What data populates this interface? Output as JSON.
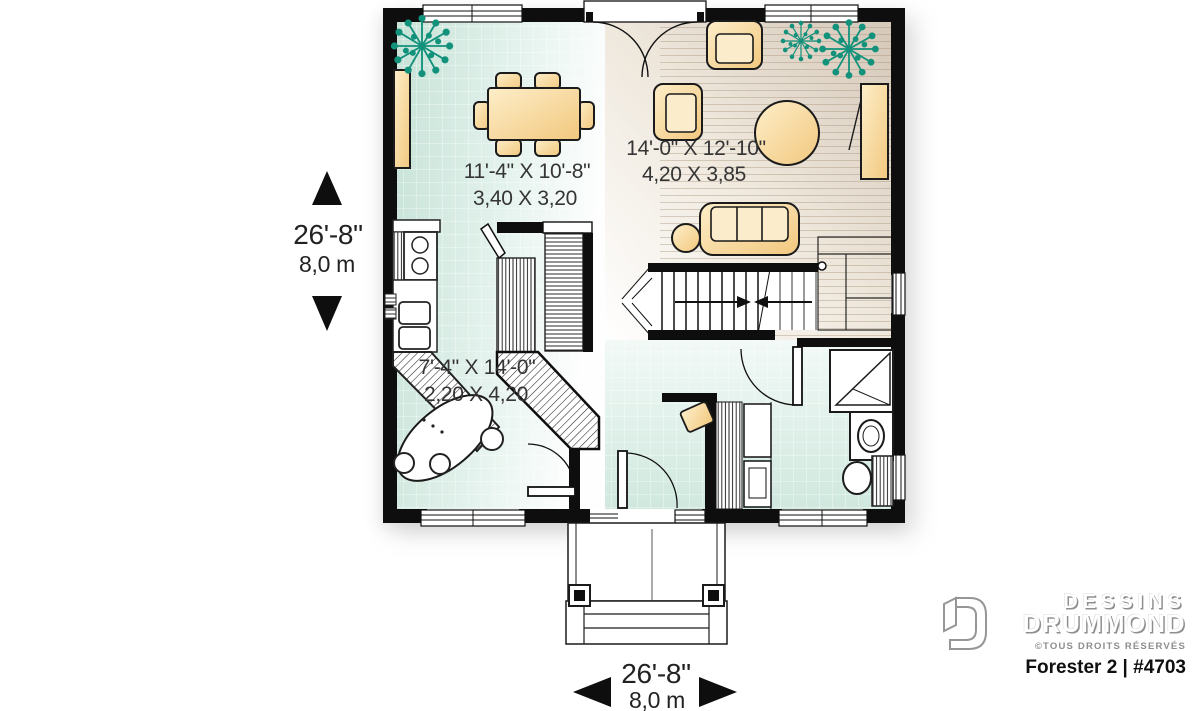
{
  "page": {
    "title": "Forester 2 | #4703",
    "type": "floor-plan"
  },
  "rooms": {
    "dining": {
      "imperial": "11'-4\" X 10'-8\"",
      "metric": "3,40 X 3,20"
    },
    "living": {
      "imperial": "14'-0\" X 12'-10\"",
      "metric": "4,20 X 3,85"
    },
    "kitchen": {
      "imperial": "7'-4\" X 14'-0\"",
      "metric": "2,20 X 4,20"
    }
  },
  "overall_dimensions": {
    "left": {
      "imperial": "26'-8\"",
      "metric": "8,0 m"
    },
    "bottom": {
      "imperial": "26'-8\"",
      "metric": "8,0 m"
    }
  },
  "branding": {
    "brand_line1": "DESSINS",
    "brand_line2": "DRUMMOND",
    "rights": "©TOUS DROITS RÉSERVÉS",
    "plan_id": "Forester 2 | #4703"
  },
  "icons": {
    "plant": "starburst-plant-icon",
    "dimension_arrows": [
      "up-triangle",
      "down-triangle",
      "left-triangle",
      "right-triangle"
    ],
    "brand_mark": "open-door-d-logo"
  },
  "colors": {
    "wall": "#0e0e0e",
    "tile_floor": "#cde5db",
    "wood_floor": "#d8cbbc",
    "furniture": "#f6d795",
    "plant": "#12917b"
  }
}
